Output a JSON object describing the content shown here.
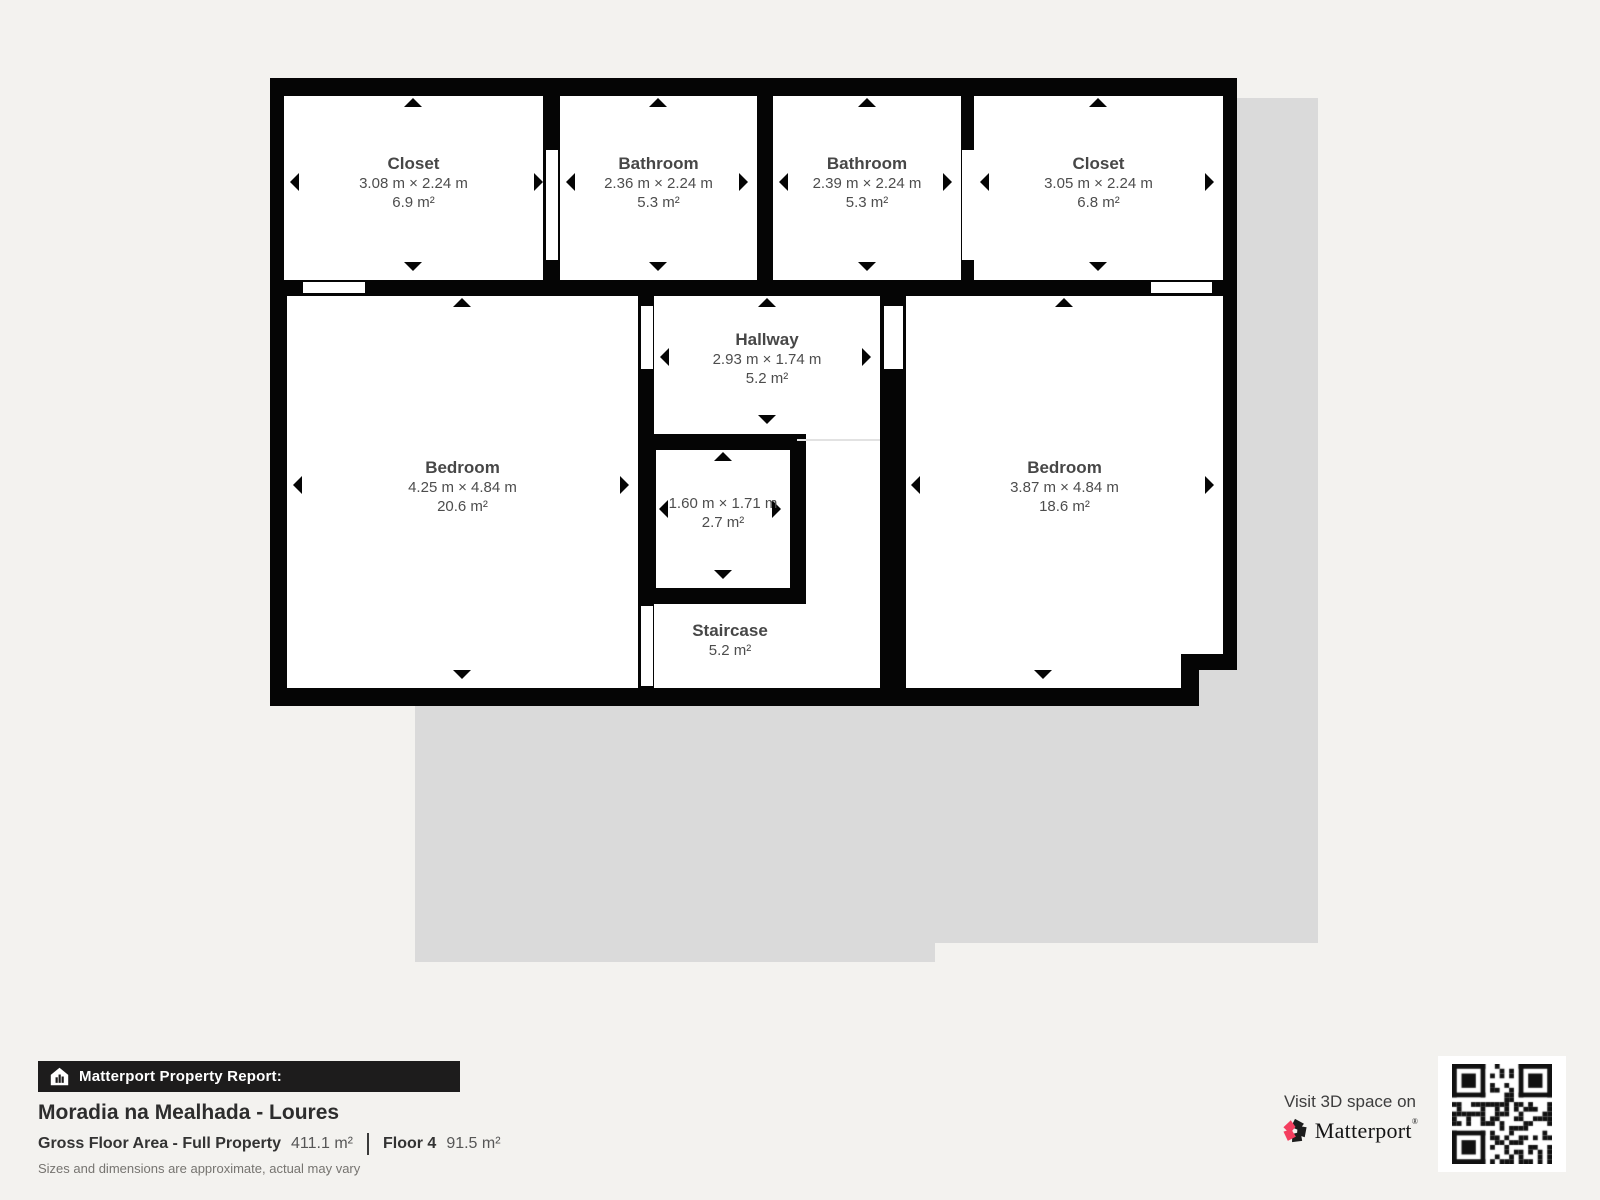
{
  "plan": {
    "rooms": [
      {
        "name": "Closet",
        "dims": "3.08 m × 2.24 m",
        "area": "6.9 m²"
      },
      {
        "name": "Bathroom",
        "dims": "2.36 m × 2.24 m",
        "area": "5.3 m²"
      },
      {
        "name": "Bathroom",
        "dims": "2.39 m × 2.24 m",
        "area": "5.3 m²"
      },
      {
        "name": "Closet",
        "dims": "3.05 m × 2.24 m",
        "area": "6.8 m²"
      },
      {
        "name": "Bedroom",
        "dims": "4.25 m × 4.84 m",
        "area": "20.6 m²"
      },
      {
        "name": "Hallway",
        "dims": "2.93 m × 1.74 m",
        "area": "5.2 m²"
      },
      {
        "name": "",
        "dims": "1.60 m × 1.71 m",
        "area": "2.7 m²"
      },
      {
        "name": "Staircase",
        "dims": "",
        "area": "5.2 m²"
      },
      {
        "name": "Bedroom",
        "dims": "3.87 m × 4.84 m",
        "area": "18.6 m²"
      }
    ]
  },
  "footer": {
    "report_label": "Matterport Property Report:",
    "property_title": "Moradia na Mealhada - Loures",
    "gfa_label": "Gross Floor Area - Full Property",
    "gfa_value": "411.1 m²",
    "floor_label": "Floor 4",
    "floor_value": "91.5 m²",
    "disclaimer": "Sizes and dimensions are approximate, actual may vary"
  },
  "cta": {
    "visit_text": "Visit 3D space on",
    "brand": "Matterport",
    "brand_mark": "®",
    "qr_icon": "qr-code"
  },
  "colors": {
    "wall": "#050505",
    "room": "#ffffff",
    "shadow": "#dadada",
    "background": "#f3f2ef",
    "brand_pink": "#f43e5f",
    "bar_bg": "#1d1c1c"
  }
}
